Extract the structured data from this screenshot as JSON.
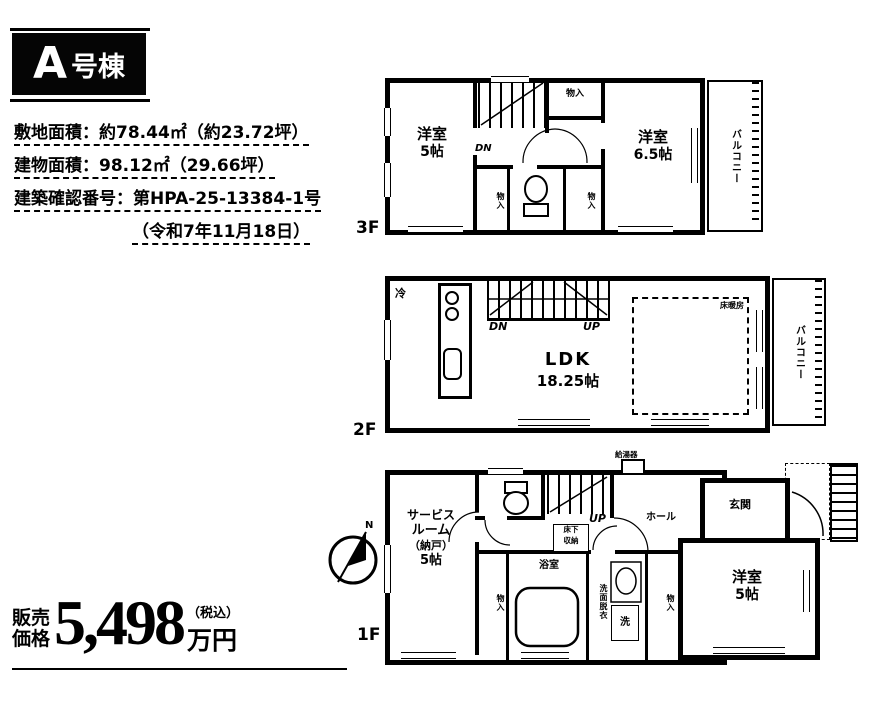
{
  "badge": {
    "letter": "A",
    "suffix": "号棟"
  },
  "info": {
    "line1": "敷地面積：約78.44㎡（約23.72坪）",
    "line2": "建物面積：98.12㎡（29.66坪）",
    "line3": "建築確認番号：第HPA-25-13384-1号",
    "line4": "（令和7年11月18日）"
  },
  "price": {
    "label1": "販売",
    "label2": "価格",
    "amount": "5,498",
    "tax": "（税込）",
    "unit": "万円"
  },
  "f3": {
    "label": "3F",
    "room_left_name": "洋室",
    "room_left_size": "5帖",
    "room_right_name": "洋室",
    "room_right_size": "6.5帖",
    "balcony": "バルコニー",
    "dn": "DN",
    "closet_top": "物入",
    "closet_l": "物入",
    "closet_r": "物入"
  },
  "f2": {
    "label": "2F",
    "ldk_name": "LDK",
    "ldk_size": "18.25帖",
    "balcony": "バルコニー",
    "dn": "DN",
    "up": "UP",
    "fridge": "冷",
    "floor_heating": "床暖房"
  },
  "f1": {
    "label": "1F",
    "service1": "サービス",
    "service2": "ルーム",
    "service3": "（納戸）",
    "service4": "5帖",
    "room_name": "洋室",
    "room_size": "5帖",
    "bath": "浴室",
    "hall": "ホール",
    "entrance": "玄関",
    "up": "UP",
    "closet_l": "物入",
    "closet_r": "物入",
    "washroom": "洗面脱衣",
    "laundry": "洗",
    "underfloor1": "床下",
    "underfloor2": "収納",
    "water_heater": "給湯器",
    "north": "N"
  }
}
